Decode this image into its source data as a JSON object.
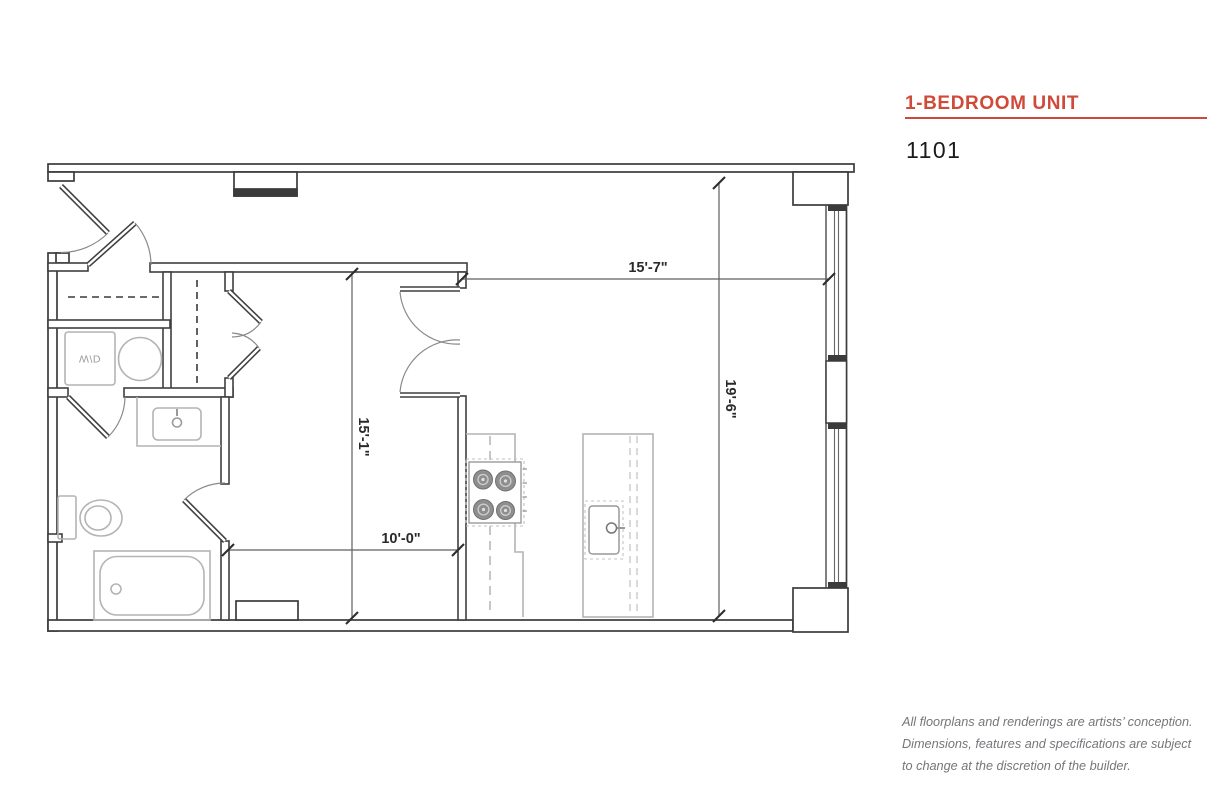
{
  "header": {
    "title": "1-BEDROOM UNIT",
    "unit_number": "1101"
  },
  "floorplan": {
    "appliance_label": "W/D",
    "dimensions": {
      "living_width": "15'-7\"",
      "living_depth": "19'-6\"",
      "bedroom_depth": "15'-1\"",
      "bedroom_width": "10'-0\""
    }
  },
  "disclaimer": {
    "lines": [
      "All floorplans and renderings are artists’ conception.",
      "Dimensions, features and specifications are subject",
      "to change at the discretion of the builder."
    ]
  },
  "colors": {
    "accent": "#d04a39",
    "wall": "#3b3b3b",
    "fixture": "#b4b4b4",
    "dimension_text": "#2a2a2a",
    "disclaimer_text": "#75767a"
  }
}
